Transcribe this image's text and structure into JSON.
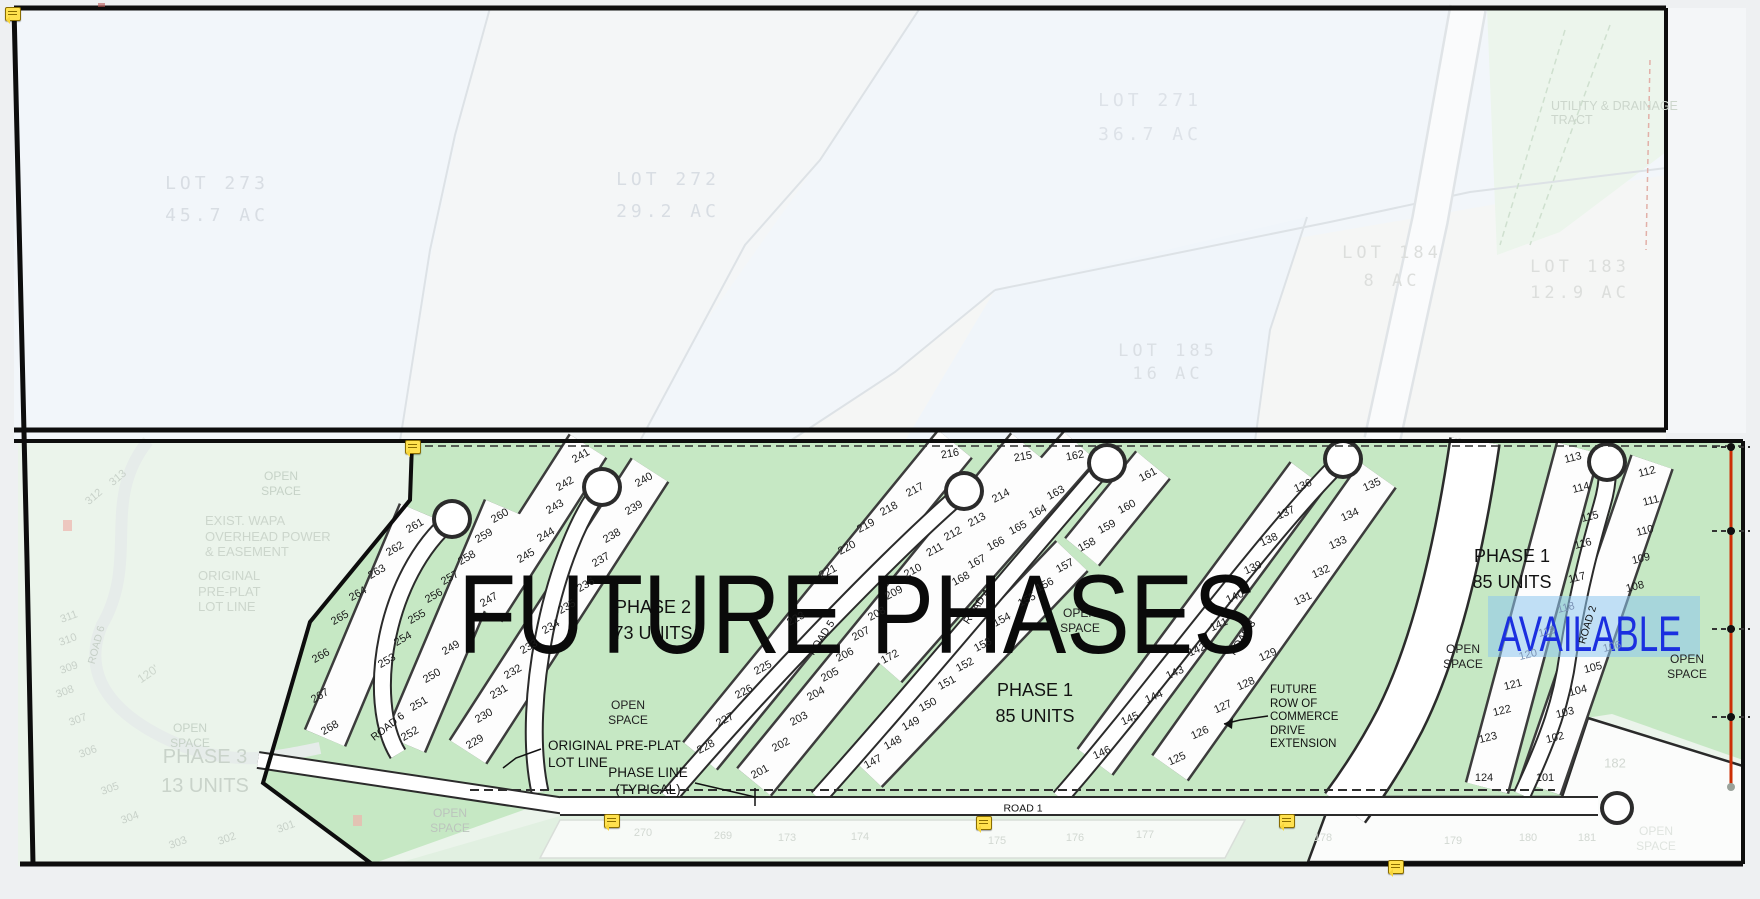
{
  "drawing": {
    "kind": "subdivision plat / phasing plan",
    "accent_colors": {
      "open_space_green": "#c6e8c4",
      "faint_green": "#ebf4eb",
      "available_highlight": "#8ec6ee",
      "available_text_blue": "#1b2fe0",
      "survey_line_red": "#cc2f05",
      "note_marker_yellow": "#ffe14e"
    }
  },
  "labels": [
    {
      "name": "lot-273-label",
      "lines": [
        "LOT 273",
        "45.7 AC"
      ],
      "x": 217,
      "y": 200,
      "size": 18,
      "lh": 32,
      "ls": 4,
      "mono": true,
      "color": "#d8dde3"
    },
    {
      "name": "lot-272-label",
      "lines": [
        "LOT 272",
        "29.2 AC"
      ],
      "x": 668,
      "y": 196,
      "size": 18,
      "lh": 32,
      "ls": 4,
      "mono": true,
      "color": "#d8dde3"
    },
    {
      "name": "lot-271-label",
      "lines": [
        "LOT 271",
        "36.7 AC"
      ],
      "x": 1150,
      "y": 118,
      "size": 18,
      "lh": 34,
      "ls": 4,
      "mono": true,
      "color": "#dde2e8"
    },
    {
      "name": "lot-184-label",
      "lines": [
        "LOT 184",
        "8 AC"
      ],
      "x": 1392,
      "y": 267,
      "size": 17,
      "lh": 28,
      "ls": 4,
      "mono": true,
      "color": "#dcdedc"
    },
    {
      "name": "lot-183-label",
      "lines": [
        "LOT 183",
        "12.9 AC"
      ],
      "x": 1580,
      "y": 280,
      "size": 17,
      "lh": 26,
      "ls": 4,
      "mono": true,
      "color": "#dcdedc"
    },
    {
      "name": "lot-185-label",
      "lines": [
        "LOT 185",
        "16 AC"
      ],
      "x": 1168,
      "y": 363,
      "size": 17,
      "lh": 23,
      "ls": 4,
      "mono": true,
      "color": "#dadfe4"
    },
    {
      "name": "utility-drainage-tract-label",
      "lines": [
        "UTILITY & DRAINAGE",
        "TRACT"
      ],
      "x": 1551,
      "y": 99,
      "size": 12.5,
      "lh": 14,
      "align": "l",
      "color": "#ccd6cc"
    },
    {
      "name": "phase-3-label",
      "lines": [
        "PHASE 3",
        "13 UNITS"
      ],
      "x": 205,
      "y": 772,
      "size": 20,
      "lh": 29,
      "color": "#c9d3ca"
    },
    {
      "name": "phase-2-label",
      "lines": [
        "PHASE 2",
        "73 UNITS"
      ],
      "x": 653,
      "y": 620,
      "size": 18,
      "lh": 26,
      "color": "#121212"
    },
    {
      "name": "phase-1-center-label",
      "lines": [
        "PHASE 1",
        "85 UNITS"
      ],
      "x": 1035,
      "y": 703,
      "size": 18,
      "lh": 26,
      "color": "#121212"
    },
    {
      "name": "phase-1-right-label",
      "lines": [
        "PHASE 1",
        "85 UNITS"
      ],
      "x": 1512,
      "y": 569,
      "size": 18,
      "lh": 26,
      "color": "#121212"
    },
    {
      "name": "open-space-label",
      "lines": [
        "OPEN",
        "SPACE"
      ],
      "x": 628,
      "y": 713,
      "size": 12,
      "lh": 15,
      "color": "#222"
    },
    {
      "name": "open-space-label",
      "lines": [
        "OPEN",
        "SPACE"
      ],
      "x": 1080,
      "y": 621,
      "size": 12,
      "lh": 15,
      "color": "#222"
    },
    {
      "name": "open-space-label",
      "lines": [
        "OPEN",
        "SPACE"
      ],
      "x": 1463,
      "y": 657,
      "size": 12,
      "lh": 15,
      "color": "#222"
    },
    {
      "name": "open-space-label",
      "lines": [
        "OPEN",
        "SPACE"
      ],
      "x": 1687,
      "y": 667,
      "size": 12,
      "lh": 15,
      "color": "#222"
    },
    {
      "name": "open-space-faint-label",
      "lines": [
        "OPEN",
        "SPACE"
      ],
      "x": 281,
      "y": 484,
      "size": 12,
      "lh": 15,
      "color": "#c6d2c7"
    },
    {
      "name": "open-space-faint-label",
      "lines": [
        "OPEN",
        "SPACE"
      ],
      "x": 190,
      "y": 736,
      "size": 12,
      "lh": 15,
      "color": "#c6d2c7"
    },
    {
      "name": "open-space-faint-label",
      "lines": [
        "OPEN",
        "SPACE"
      ],
      "x": 450,
      "y": 821,
      "size": 12,
      "lh": 15,
      "color": "#bcc4bd"
    },
    {
      "name": "open-space-faint-label",
      "lines": [
        "OPEN",
        "SPACE"
      ],
      "x": 1656,
      "y": 839,
      "size": 12,
      "lh": 15,
      "color": "#dfe4df"
    },
    {
      "name": "road-1-label",
      "lines": [
        "ROAD 1"
      ],
      "x": 1023,
      "y": 809,
      "size": 10.5,
      "color": "#111"
    },
    {
      "name": "road-6-label",
      "lines": [
        "ROAD 6"
      ],
      "x": 388,
      "y": 727,
      "size": 10.5,
      "rot": -38,
      "color": "#111"
    },
    {
      "name": "road-5-label",
      "lines": [
        "ROAD 5"
      ],
      "x": 822,
      "y": 638,
      "size": 10.5,
      "rot": -57,
      "color": "#111"
    },
    {
      "name": "road-4-label",
      "lines": [
        "ROAD 4"
      ],
      "x": 977,
      "y": 607,
      "size": 10.5,
      "rot": -57,
      "color": "#111"
    },
    {
      "name": "road-3-label",
      "lines": [
        "ROAD 3"
      ],
      "x": 1243,
      "y": 638,
      "size": 10.5,
      "rot": -57,
      "color": "#111"
    },
    {
      "name": "road-2-label",
      "lines": [
        "ROAD 2"
      ],
      "x": 1588,
      "y": 625,
      "size": 10.5,
      "rot": -73,
      "color": "#111"
    },
    {
      "name": "road-6-faint-label",
      "lines": [
        "ROAD 6"
      ],
      "x": 97,
      "y": 645,
      "size": 10.5,
      "rot": -75,
      "color": "#c5cfc6"
    },
    {
      "name": "original-preplat-note",
      "lines": [
        "ORIGINAL PRE-PLAT",
        "LOT LINE"
      ],
      "x": 548,
      "y": 737,
      "size": 13.5,
      "lh": 17,
      "align": "l",
      "color": "#111"
    },
    {
      "name": "phase-line-note",
      "lines": [
        "PHASE LINE",
        "(TYPICAL)"
      ],
      "x": 648,
      "y": 781,
      "size": 13.5,
      "lh": 17,
      "color": "#111"
    },
    {
      "name": "future-row-commerce-note",
      "lines": [
        "FUTURE",
        "ROW OF",
        "COMMERCE",
        "DRIVE",
        "EXTENSION"
      ],
      "x": 1270,
      "y": 684,
      "size": 11.5,
      "lh": 13.5,
      "align": "l",
      "color": "#111"
    },
    {
      "name": "exist-wapa-note",
      "lines": [
        "EXIST. WAPA",
        "OVERHEAD POWER",
        "& EASEMENT"
      ],
      "x": 205,
      "y": 513,
      "size": 13,
      "lh": 15.5,
      "align": "l",
      "color": "#ccd6cc"
    },
    {
      "name": "original-preplat-faint-note",
      "lines": [
        "ORIGINAL",
        "PRE-PLAT",
        "LOT LINE"
      ],
      "x": 198,
      "y": 568,
      "size": 13,
      "lh": 15.5,
      "align": "l",
      "color": "#ccd6cc"
    },
    {
      "name": "dim-120-label",
      "lines": [
        "120'"
      ],
      "x": 148,
      "y": 674,
      "size": 12,
      "rot": -35,
      "color": "#ccd6cc"
    },
    {
      "name": "available-label",
      "lines": [
        "AVAILABLE"
      ],
      "x": 1498,
      "y": 604,
      "size": 50,
      "sx": 0.7,
      "align": "l",
      "color": "#1b2fe0",
      "inter": true
    },
    {
      "name": "future-phases-overlay",
      "lines": [
        "FUTURE PHASES"
      ],
      "x": 458,
      "y": 548,
      "size": 112,
      "sx": 0.85,
      "align": "l",
      "color": "#0a0a0a",
      "inter": true
    }
  ],
  "lot_groups": [
    {
      "name": "lot-number",
      "rot": -30,
      "size": 11,
      "color": "#1c1c1c",
      "items": [
        [
          "261",
          415,
          526
        ],
        [
          "262",
          395,
          549
        ],
        [
          "263",
          377,
          572
        ],
        [
          "264",
          358,
          594
        ],
        [
          "265",
          340,
          618
        ],
        [
          "266",
          321,
          656
        ],
        [
          "267",
          320,
          696
        ],
        [
          "268",
          330,
          728
        ],
        [
          "260",
          500,
          516
        ],
        [
          "259",
          484,
          536
        ],
        [
          "258",
          467,
          558
        ],
        [
          "257",
          450,
          578
        ],
        [
          "256",
          434,
          596
        ],
        [
          "255",
          417,
          617
        ],
        [
          "254",
          403,
          639
        ],
        [
          "253",
          387,
          661
        ],
        [
          "249",
          451,
          648
        ],
        [
          "250",
          432,
          676
        ],
        [
          "251",
          419,
          704
        ],
        [
          "252",
          410,
          734
        ],
        [
          "241",
          581,
          456
        ],
        [
          "242",
          565,
          484
        ],
        [
          "243",
          555,
          507
        ],
        [
          "244",
          546,
          535
        ],
        [
          "245",
          526,
          556
        ],
        [
          "247",
          489,
          600
        ],
        [
          "240",
          644,
          480
        ],
        [
          "239",
          634,
          508
        ],
        [
          "238",
          612,
          536
        ],
        [
          "237",
          601,
          560
        ],
        [
          "236",
          586,
          585
        ],
        [
          "235",
          567,
          607
        ],
        [
          "234",
          551,
          627
        ],
        [
          "233",
          529,
          647
        ],
        [
          "232",
          513,
          672
        ],
        [
          "231",
          499,
          692
        ],
        [
          "230",
          484,
          716
        ],
        [
          "229",
          475,
          742
        ]
      ]
    },
    {
      "name": "lot-number",
      "rot": -28,
      "size": 11,
      "color": "#1c1c1c",
      "items": [
        [
          "216",
          950,
          454,
          null,
          -10
        ],
        [
          "217",
          915,
          490
        ],
        [
          "218",
          889,
          509
        ],
        [
          "219",
          866,
          526
        ],
        [
          "220",
          847,
          548
        ],
        [
          "221",
          828,
          572
        ],
        [
          "223",
          796,
          619
        ],
        [
          "225",
          763,
          668
        ],
        [
          "226",
          744,
          692
        ],
        [
          "227",
          725,
          720
        ],
        [
          "228",
          706,
          747
        ],
        [
          "215",
          1023,
          457,
          null,
          -10
        ],
        [
          "214",
          1001,
          496
        ],
        [
          "213",
          977,
          520
        ],
        [
          "212",
          953,
          534
        ],
        [
          "211",
          935,
          550
        ],
        [
          "210",
          913,
          571
        ],
        [
          "209",
          894,
          593
        ],
        [
          "208",
          877,
          614
        ],
        [
          "207",
          861,
          634
        ],
        [
          "206",
          845,
          655
        ],
        [
          "205",
          830,
          675
        ],
        [
          "204",
          816,
          694
        ],
        [
          "203",
          799,
          719
        ],
        [
          "202",
          781,
          745
        ],
        [
          "201",
          760,
          772
        ],
        [
          "172",
          890,
          657
        ],
        [
          "162",
          1075,
          456,
          null,
          -10
        ],
        [
          "163",
          1056,
          493
        ],
        [
          "164",
          1038,
          512
        ],
        [
          "165",
          1018,
          528
        ],
        [
          "166",
          996,
          544
        ],
        [
          "167",
          977,
          562
        ],
        [
          "168",
          961,
          579
        ],
        [
          "161",
          1148,
          475
        ],
        [
          "160",
          1127,
          507
        ],
        [
          "159",
          1107,
          527
        ],
        [
          "158",
          1087,
          545
        ],
        [
          "157",
          1065,
          566
        ],
        [
          "156",
          1045,
          585
        ],
        [
          "155",
          1027,
          600
        ],
        [
          "154",
          1002,
          620
        ],
        [
          "153",
          983,
          645
        ],
        [
          "152",
          965,
          665
        ],
        [
          "151",
          947,
          683
        ],
        [
          "150",
          928,
          705
        ],
        [
          "149",
          911,
          724
        ],
        [
          "148",
          893,
          743
        ],
        [
          "147",
          873,
          762
        ]
      ]
    },
    {
      "name": "lot-number",
      "rot": -24,
      "size": 11,
      "color": "#1c1c1c",
      "items": [
        [
          "136",
          1303,
          486
        ],
        [
          "137",
          1286,
          513
        ],
        [
          "138",
          1269,
          540
        ],
        [
          "139",
          1253,
          568
        ],
        [
          "140",
          1235,
          597
        ],
        [
          "141",
          1219,
          625
        ],
        [
          "142",
          1197,
          650
        ],
        [
          "143",
          1175,
          673
        ],
        [
          "144",
          1154,
          697
        ],
        [
          "145",
          1130,
          719
        ],
        [
          "146",
          1102,
          753
        ],
        [
          "135",
          1372,
          485
        ],
        [
          "134",
          1350,
          515
        ],
        [
          "133",
          1338,
          543
        ],
        [
          "132",
          1321,
          572
        ],
        [
          "131",
          1303,
          599
        ],
        [
          "129",
          1268,
          655
        ],
        [
          "128",
          1246,
          684
        ],
        [
          "127",
          1223,
          707
        ],
        [
          "126",
          1200,
          733
        ],
        [
          "125",
          1177,
          759
        ]
      ]
    },
    {
      "name": "lot-number",
      "rot": -14,
      "size": 11,
      "color": "#1c1c1c",
      "items": [
        [
          "113",
          1573,
          458
        ],
        [
          "114",
          1581,
          488
        ],
        [
          "115",
          1590,
          517
        ],
        [
          "116",
          1583,
          544
        ],
        [
          "117",
          1577,
          578
        ],
        [
          "118",
          1566,
          608,
          null,
          null,
          "#7d94b6"
        ],
        [
          "119",
          1547,
          632,
          null,
          null,
          "#7d94b6"
        ],
        [
          "120",
          1528,
          655,
          null,
          null,
          "#7d94b6"
        ],
        [
          "121",
          1513,
          685
        ],
        [
          "122",
          1502,
          711
        ],
        [
          "123",
          1488,
          738
        ],
        [
          "124",
          1484,
          778,
          null,
          0
        ],
        [
          "112",
          1647,
          472
        ],
        [
          "111",
          1651,
          501
        ],
        [
          "110",
          1645,
          531
        ],
        [
          "109",
          1641,
          559
        ],
        [
          "108",
          1635,
          587
        ],
        [
          "106",
          1612,
          647,
          null,
          null,
          "#7d94b6"
        ],
        [
          "105",
          1593,
          668
        ],
        [
          "104",
          1578,
          691
        ],
        [
          "103",
          1565,
          713
        ],
        [
          "102",
          1555,
          738
        ],
        [
          "101",
          1545,
          778,
          null,
          0
        ]
      ]
    },
    {
      "name": "faint-lot-number",
      "rot": -20,
      "size": 11,
      "color": "#c8d1c9",
      "items": [
        [
          "313",
          118,
          478,
          null,
          -40
        ],
        [
          "312",
          94,
          497,
          null,
          -40
        ],
        [
          "311",
          69,
          617
        ],
        [
          "310",
          68,
          640
        ],
        [
          "309",
          69,
          668
        ],
        [
          "308",
          65,
          692
        ],
        [
          "307",
          78,
          720
        ],
        [
          "306",
          88,
          752
        ],
        [
          "305",
          110,
          789
        ],
        [
          "304",
          130,
          818
        ],
        [
          "303",
          178,
          843
        ],
        [
          "302",
          227,
          839
        ],
        [
          "301",
          286,
          827
        ]
      ]
    },
    {
      "name": "faint-lot-number",
      "rot": 0,
      "size": 11,
      "color": "#d2d8d2",
      "items": [
        [
          "270",
          643,
          833
        ],
        [
          "269",
          723,
          836
        ],
        [
          "173",
          787,
          838
        ],
        [
          "174",
          860,
          837
        ],
        [
          "175",
          997,
          841
        ],
        [
          "176",
          1075,
          838
        ],
        [
          "177",
          1145,
          835
        ],
        [
          "178",
          1323,
          838
        ],
        [
          "179",
          1453,
          841
        ],
        [
          "180",
          1528,
          838
        ],
        [
          "181",
          1587,
          838
        ],
        [
          "182",
          1615,
          763,
          13
        ]
      ]
    }
  ],
  "note_markers": [
    [
      12,
      13
    ],
    [
      412,
      446
    ],
    [
      611,
      820
    ],
    [
      983,
      822
    ],
    [
      1286,
      820
    ],
    [
      1395,
      866
    ]
  ],
  "misc_marks": [
    [
      67,
      525
    ],
    [
      357,
      820
    ]
  ]
}
